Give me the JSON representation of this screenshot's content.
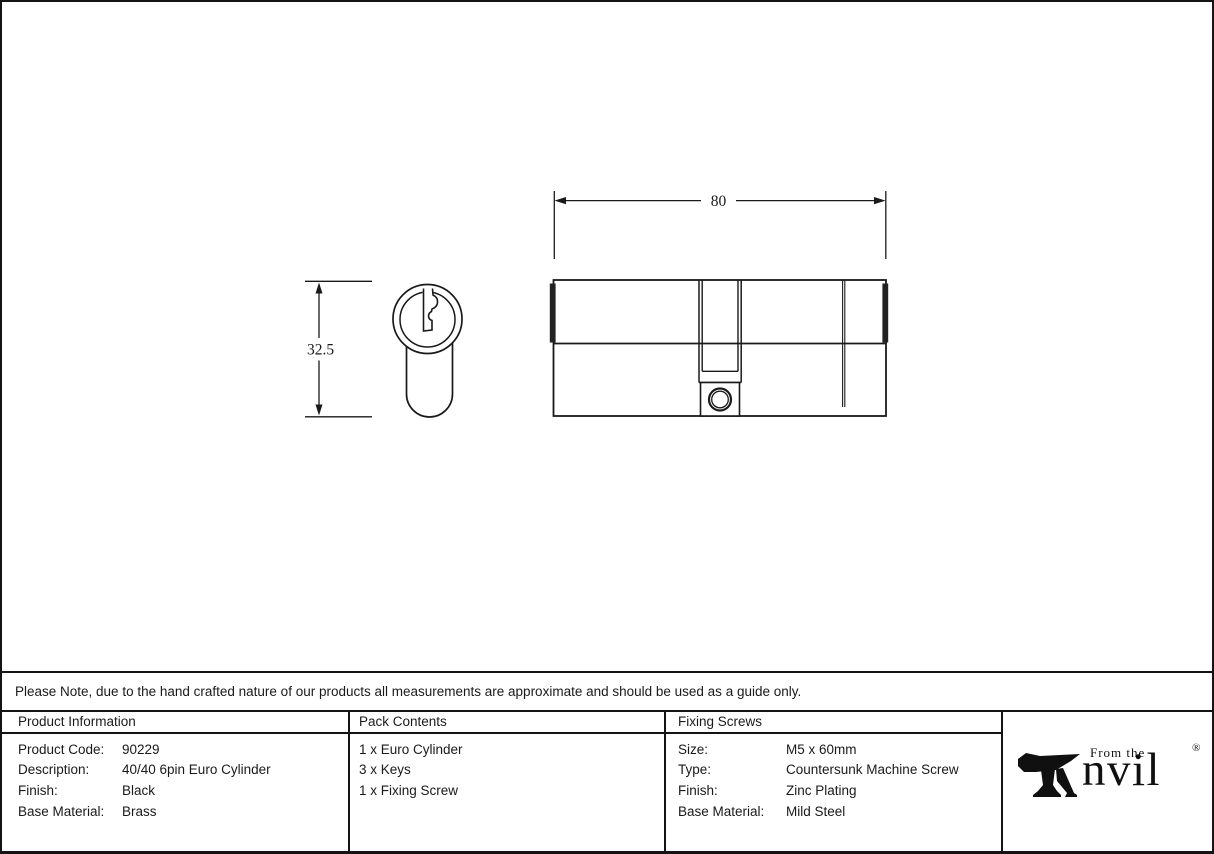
{
  "drawing": {
    "length_dim_label": "80",
    "height_dim_label": "32.5"
  },
  "note": "Please Note, due to the hand crafted nature of our products all measurements are approximate and should be used as a guide only.",
  "table": {
    "product_information": {
      "header": "Product Information",
      "rows": [
        {
          "label": "Product Code:",
          "value": "90229"
        },
        {
          "label": "Description:",
          "value": "40/40 6pin Euro Cylinder"
        },
        {
          "label": "Finish:",
          "value": "Black"
        },
        {
          "label": "Base Material:",
          "value": "Brass"
        }
      ]
    },
    "pack_contents": {
      "header": "Pack Contents",
      "items": [
        "1 x Euro Cylinder",
        "3 x Keys",
        "1 x Fixing Screw"
      ]
    },
    "fixing_screws": {
      "header": "Fixing Screws",
      "rows": [
        {
          "label": "Size:",
          "value": "M5 x 60mm"
        },
        {
          "label": "Type:",
          "value": "Countersunk Machine Screw"
        },
        {
          "label": "Finish:",
          "value": "Zinc Plating"
        },
        {
          "label": "Base Material:",
          "value": "Mild Steel"
        }
      ]
    }
  },
  "logo": {
    "prefix": "From the",
    "name_suffix": "nvil",
    "registered": "®"
  },
  "colors": {
    "line": "#1a1a1a",
    "ink": "#141414",
    "background": "#ffffff"
  }
}
